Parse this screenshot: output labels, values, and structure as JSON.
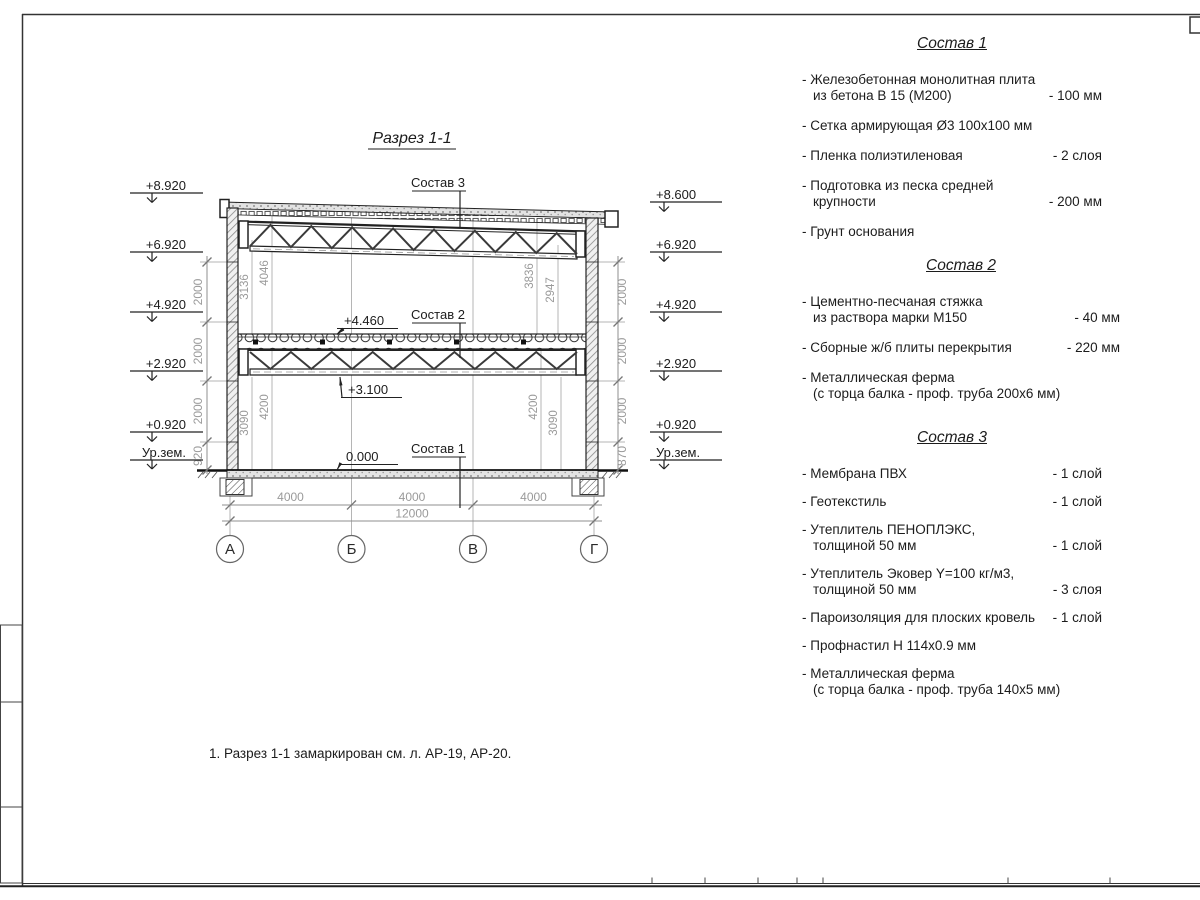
{
  "sheet": {
    "note": "1. Разрез 1-1 замаркирован см. л. АР-19, АР-20."
  },
  "drawing": {
    "title": "Разрез 1-1",
    "layer_labels": {
      "top": "Состав 3",
      "mid": "Состав 2",
      "bottom": "Состав 1"
    },
    "spot_elevations": {
      "slab_top": "+4.460",
      "truss_bottom": "+3.100",
      "floor": "0.000"
    },
    "elev_left": [
      "+8.920",
      "+6.920",
      "+4.920",
      "+2.920",
      "+0.920",
      "Ур.зем."
    ],
    "elev_right": [
      "+8.600",
      "+6.920",
      "+4.920",
      "+2.920",
      "+0.920",
      "Ур.зем."
    ],
    "dims_left": [
      "2000",
      "2000",
      "2000",
      "920"
    ],
    "dims_right": [
      "2000",
      "2000",
      "2000",
      "870"
    ],
    "dims_inner": {
      "upper_left": [
        "3136",
        "4046"
      ],
      "upper_right": [
        "3836",
        "2947"
      ],
      "lower_left": [
        "3090",
        "4200"
      ],
      "lower_right": [
        "4200",
        "3090"
      ]
    },
    "grid": {
      "letters": [
        "А",
        "Б",
        "В",
        "Г"
      ],
      "spans": [
        "4000",
        "4000",
        "4000"
      ],
      "total": "12000"
    }
  },
  "compositions": [
    {
      "title": "Состав 1",
      "items": [
        {
          "label": "- Железобетонная монолитная плита\nиз бетона В 15 (М200)",
          "value": "- 100 мм"
        },
        {
          "label": "- Сетка армирующая Ø3 100x100 мм",
          "value": ""
        },
        {
          "label": "- Пленка полиэтиленовая",
          "value": "- 2 слоя"
        },
        {
          "label": "- Подготовка из песка средней\nкрупности",
          "value": "- 200 мм"
        },
        {
          "label": "- Грунт основания",
          "value": ""
        }
      ]
    },
    {
      "title": "Состав 2",
      "items": [
        {
          "label": "- Цементно-песчаная стяжка\nиз раствора марки М150",
          "value": "- 40 мм"
        },
        {
          "label": "- Сборные ж/б плиты перекрытия",
          "value": "- 220 мм"
        },
        {
          "label": "- Металлическая ферма\n(с торца балка - проф. труба 200x6 мм)",
          "value": ""
        }
      ]
    },
    {
      "title": "Состав 3",
      "items": [
        {
          "label": "- Мембрана ПВХ",
          "value": "- 1 слой"
        },
        {
          "label": "- Геотекстиль",
          "value": "- 1 слой"
        },
        {
          "label": "- Утеплитель ПЕНОПЛЭКС,\nтолщиной 50 мм",
          "value": "- 1 слой"
        },
        {
          "label": "- Утеплитель Эковер Y=100 кг/м3,\nтолщиной 50 мм",
          "value": "- 3 слоя"
        },
        {
          "label": "- Пароизоляция для плоских кровель",
          "value": "- 1 слой"
        },
        {
          "label": "- Профнастил Н 114x0.9 мм",
          "value": ""
        },
        {
          "label": "- Металлическая ферма\n(с торца балка - проф. труба 140x5 мм)",
          "value": ""
        }
      ]
    }
  ]
}
